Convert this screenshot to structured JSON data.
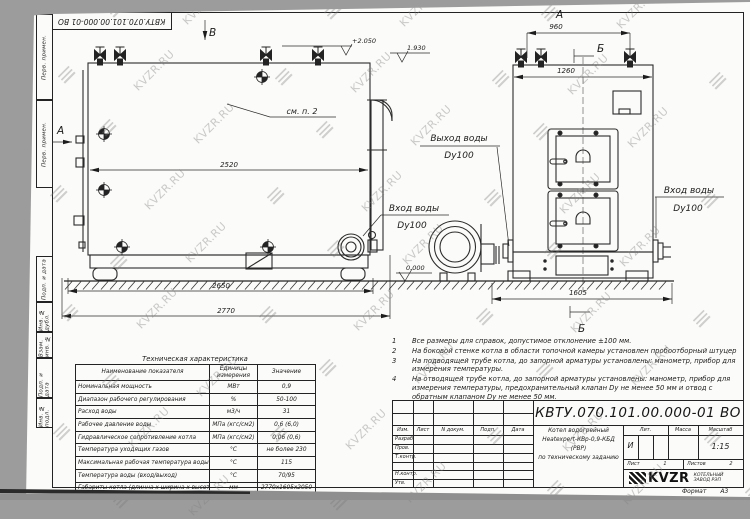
{
  "watermark": {
    "text": "KVZR.RU"
  },
  "frame": {
    "top_stamp": "КВТУ.070.101.00.000-01 ВО",
    "margin_boxes": [
      "Перв. примен.",
      "Перв. примен.",
      "Подп. и дата",
      "Инв. № дубл.",
      "Взам. инв. №",
      "Подп. и дата",
      "Инв. № подл."
    ],
    "format_label": "Формат",
    "format_value": "А3"
  },
  "drawing": {
    "markers": {
      "a_side": "А",
      "a_top": "А",
      "b_top": "Б",
      "b_bottom": "Б",
      "v_top": "В"
    },
    "labels": {
      "see_note": "см. п. 2",
      "outlet_title": "Выход воды",
      "outlet_dn": "Dy100",
      "inlet_title": "Вход воды",
      "inlet_dn": "Dy100",
      "inlet_right_title": "Вход воды",
      "inlet_right_dn": "Dy100"
    },
    "dims": {
      "body_len": "2520",
      "base_len": "2650",
      "total_len": "2770",
      "top_width": "960",
      "front_width": "1260",
      "total_width": "1605"
    },
    "elev": {
      "top": "+2.050",
      "duct": "1.930",
      "zero": "0.000"
    }
  },
  "notes": {
    "items": [
      {
        "n": "1",
        "text": "Все размеры для справок, допустимое отклонение  ±100 мм."
      },
      {
        "n": "2",
        "text": "На боковой стенке котла в области топочной камеры установлен пробоотборный штуцер"
      },
      {
        "n": "3",
        "text": "На  подводящей трубе котла, до запорной арматуры установлены: манометр, прибор для измерения температуры."
      },
      {
        "n": "4",
        "text": "На отводящей трубе котла, до запорной арматуры установлены: манометр, прибор для измерения температуры, предохранительный клапан Dу не менее 50 мм и отвод с обратным клапаном Dу не менее 50 мм."
      }
    ]
  },
  "tech_table": {
    "title": "Техническая характеристика",
    "headers": [
      "Наименование показателя",
      "Единицы измерения",
      "Значение"
    ],
    "rows": [
      [
        "Номинальная мощность",
        "МВт",
        "0,9"
      ],
      [
        "Диапазон рабочего регулирования",
        "%",
        "50-100"
      ],
      [
        "Расход воды",
        "м3/ч",
        "31"
      ],
      [
        "Рабочее давление воды",
        "МПа (кгс/см2)",
        "0,6 (6,0)"
      ],
      [
        "Гидравлическое сопротивление котла",
        "МПа (кгс/см2)",
        "0,06 (0,6)"
      ],
      [
        "Температура уходящих газов",
        "°С",
        "не более 230"
      ],
      [
        "Максимальная рабочая температура воды",
        "°С",
        "115"
      ],
      [
        "Температура воды (вход/выход)",
        "°С",
        "70/95"
      ],
      [
        "Габариты котла (длинна х ширина х высота)",
        "мм",
        "2770х1605х2050"
      ]
    ]
  },
  "title_block": {
    "doc_number": "КВТУ.070.101.00.000-01 ВО",
    "header_cols": [
      "Изм.",
      "Лист",
      "N докум.",
      "Подп.",
      "Дата"
    ],
    "row_labels": [
      "Разраб.",
      "Пров.",
      "Т.контр.",
      "",
      "Н.контр.",
      "Утв."
    ],
    "name_line1": "Котел водогрейный",
    "name_line2": "Heatexpert-КВр-0,9-КБД (РВР)",
    "name_line3": "по техническому заданию",
    "lit_label": "Лит.",
    "lit_value": "И",
    "mass_label": "Масса",
    "scale_label": "Масштаб",
    "scale_value": "1:15",
    "sheet_label": "Лист",
    "sheet_value": "1",
    "sheets_label": "Листов",
    "sheets_value": "2",
    "company": "KVZR",
    "company_sub1": "КОТЕЛЬНЫЙ",
    "company_sub2": "ЗАВОД РЭП"
  }
}
